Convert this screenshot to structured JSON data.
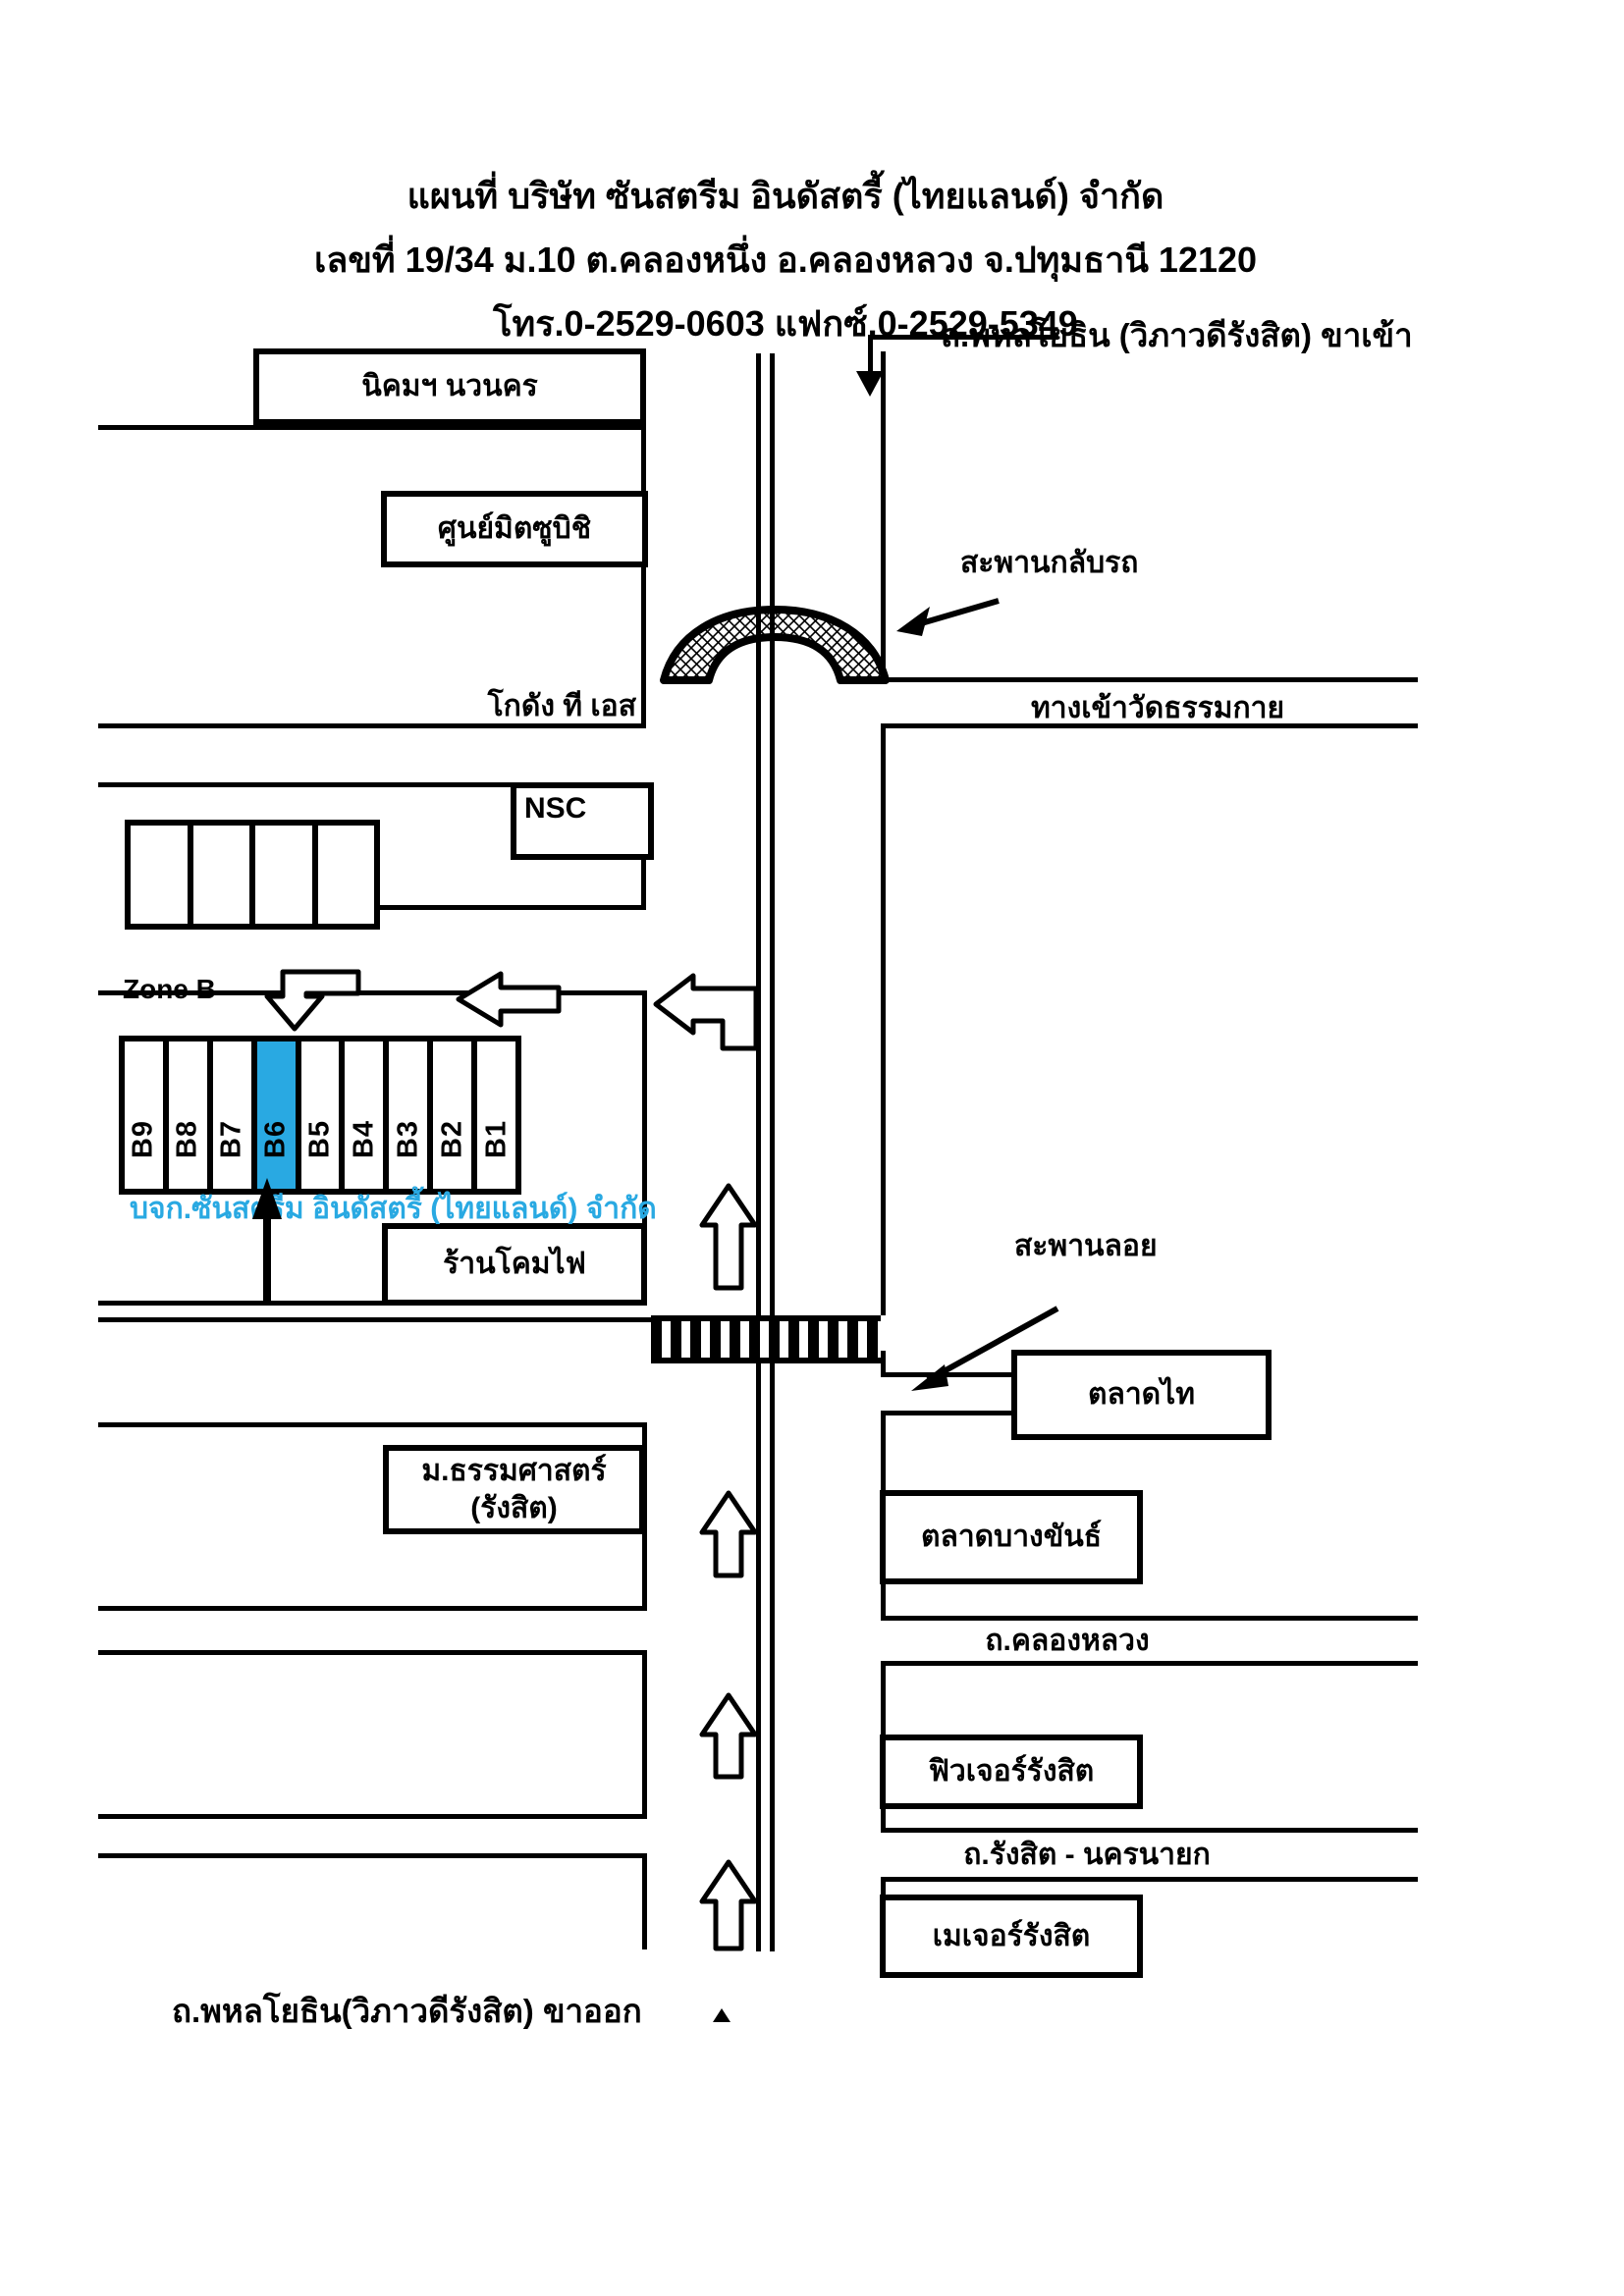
{
  "title": {
    "line1": "แผนที่ บริษัท ซันสตรีม อินดัสตรี้ (ไทยแลนด์) จำกัด",
    "line2": "เลขที่ 19/34 ม.10  ต.คลองหนึ่ง อ.คลองหลวง จ.ปทุมธานี 12120",
    "line3": "โทร.0-2529-0603  แฟกซ์.0-2529-5349"
  },
  "roads": {
    "inbound": "ถ.พหลโยธิน (วิภาวดีรังสิต) ขาเข้า",
    "outbound": "ถ.พหลโยธิน(วิภาวดีรังสิต) ขาออก",
    "wat_entrance": "ทางเข้าวัดธรรมกาย",
    "khlong_luang": "ถ.คลองหลวง",
    "rangsit_nakhonnayok": "ถ.รังสิต - นครนายก"
  },
  "bridges": {
    "uturn_bridge": "สะพานกลับรถ",
    "pedestrian_bridge": "สะพานลอย"
  },
  "landmarks": {
    "nikhom_navanakorn": "นิคมฯ นวนคร",
    "mitsubishi_center": "ศูนย์มิตซูบิชิ",
    "ts_warehouse": "โกดัง ที เอส",
    "nsc": "NSC",
    "lamp_shop": "ร้านโคมไฟ",
    "thammasat_line1": "ม.ธรรมศาสตร์",
    "thammasat_line2": "(รังสิต)",
    "talad_thai": "ตลาดไท",
    "talad_bangkhan": "ตลาดบางขันธ์",
    "future_rangsit": "ฟิวเจอร์รังสิต",
    "major_rangsit": "เมเจอร์รังสิต"
  },
  "zone_b": {
    "label": "Zone B",
    "slots": [
      "B9",
      "B8",
      "B7",
      "B6",
      "B5",
      "B4",
      "B3",
      "B2",
      "B1"
    ],
    "highlighted_slot": "B6",
    "company_caption": "บจก.ซันสตรีม อินดัสตรี้ (ไทยแลนด์) จำกัด"
  },
  "colors": {
    "highlight": "#29A9E2",
    "line": "#000000",
    "background": "#FFFFFF"
  }
}
